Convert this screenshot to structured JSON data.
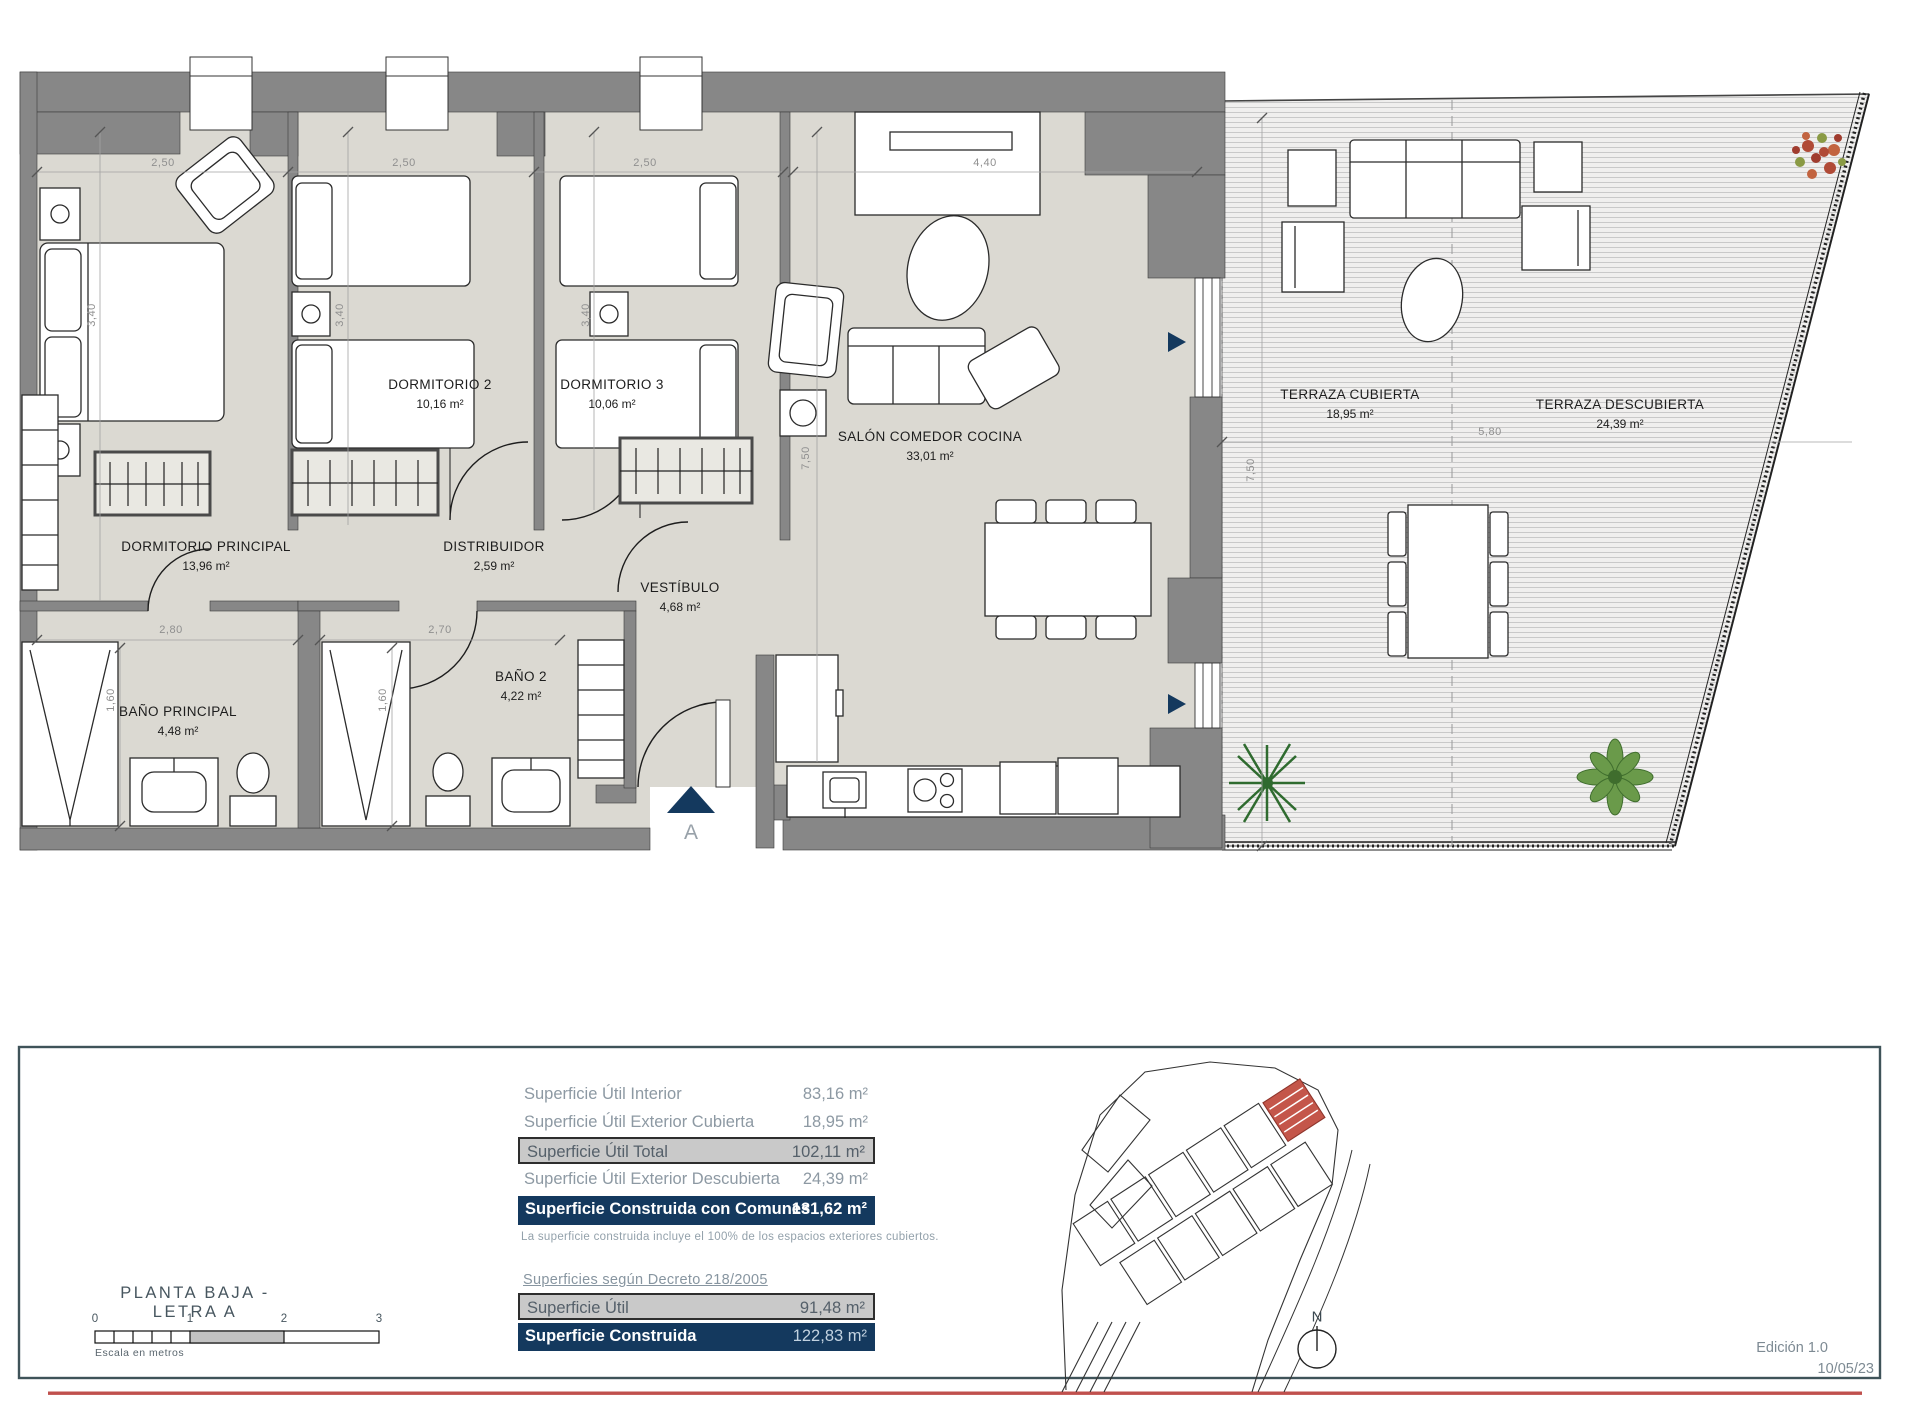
{
  "colors": {
    "wall_gray": "#878787",
    "floor_beige": "#dbd9d2",
    "terrace_line": "#c9c9c9",
    "navy_accent": "#14395e",
    "highlight_gray": "#c9c9c9",
    "red_rule": "#c0504d",
    "site_unit_red": "#c4564a"
  },
  "plan": {
    "rooms": [
      {
        "name": "DORMITORIO PRINCIPAL",
        "area": "13,96 m²"
      },
      {
        "name": "DORMITORIO 2",
        "area": "10,16 m²"
      },
      {
        "name": "DORMITORIO 3",
        "area": "10,06 m²"
      },
      {
        "name": "DISTRIBUIDOR",
        "area": "2,59 m²"
      },
      {
        "name": "VESTÍBULO",
        "area": "4,68 m²"
      },
      {
        "name": "BAÑO PRINCIPAL",
        "area": "4,48 m²"
      },
      {
        "name": "BAÑO 2",
        "area": "4,22 m²"
      },
      {
        "name": "SALÓN COMEDOR COCINA",
        "area": "33,01 m²"
      },
      {
        "name": "TERRAZA CUBIERTA",
        "area": "18,95 m²"
      },
      {
        "name": "TERRAZA DESCUBIERTA",
        "area": "24,39 m²"
      }
    ],
    "dimensions": [
      "2,50",
      "2,50",
      "2,50",
      "4,40",
      "3,40",
      "3,40",
      "3,40",
      "7,50",
      "2,80",
      "2,70",
      "1,60",
      "1,60",
      "7,50",
      "5,80"
    ],
    "entrance_label": "A"
  },
  "footer": {
    "title": "PLANTA BAJA - LETRA A",
    "scale": {
      "ticks": [
        "0",
        "1",
        "2",
        "3"
      ],
      "caption": "Escala en metros"
    },
    "areas_table": {
      "rows": [
        {
          "label": "Superficie Útil Interior",
          "value": "83,16 m²",
          "style": "plain"
        },
        {
          "label": "Superficie Útil Exterior Cubierta",
          "value": "18,95 m²",
          "style": "plain"
        },
        {
          "label": "Superficie Útil Total",
          "value": "102,11 m²",
          "style": "gray"
        },
        {
          "label": "Superficie Útil Exterior Descubierta",
          "value": "24,39 m²",
          "style": "plain"
        },
        {
          "label": "Superficie Construida con Comunes",
          "value": "131,62 m²",
          "style": "navy"
        }
      ],
      "note": "La superficie construida incluye el 100% de los espacios exteriores cubiertos."
    },
    "decree": {
      "heading": "Superficies según Decreto 218/2005",
      "rows": [
        {
          "label": "Superficie Útil",
          "value": "91,48 m²",
          "style": "gray"
        },
        {
          "label": "Superficie Construida",
          "value": "122,83 m²",
          "style": "navy"
        }
      ]
    },
    "north_label": "N",
    "edition": "Edición 1.0",
    "date": "10/05/23"
  }
}
